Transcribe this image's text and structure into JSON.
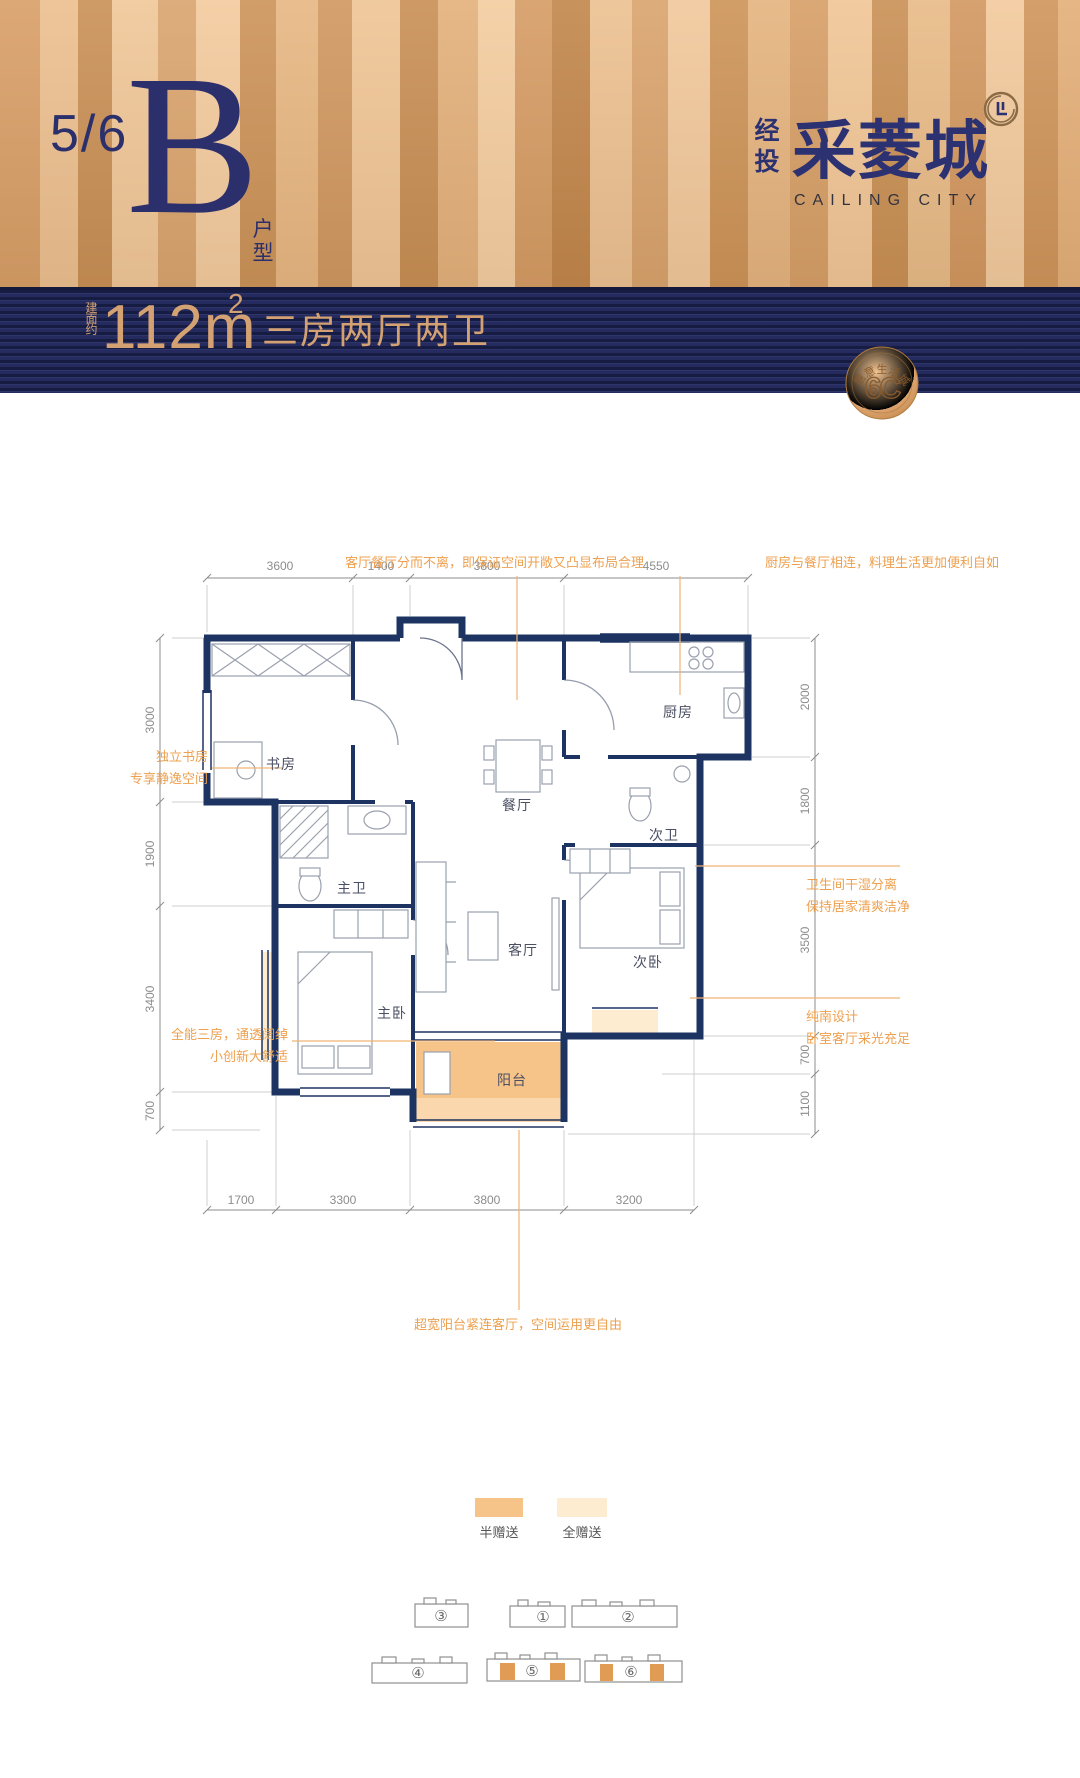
{
  "header": {
    "floors": "5/6",
    "unit": "B",
    "unit_type": "户型",
    "brand_prefix": "经投",
    "brand_name": "采菱城",
    "brand_en": "CAILING CITY"
  },
  "banner": {
    "area_prefix": "建面约",
    "area_value": "112m",
    "area_sup": "2",
    "layout": "三房两厅两卫",
    "badge_ring": "惬意生活城",
    "badge_center": "6C"
  },
  "annotations": {
    "dining": "客厅餐厅分而不离，即保证空间开敞又凸显布局合理",
    "kitchen": "厨房与餐厅相连，料理生活更加便利自如",
    "study1": "独立书房",
    "study2": "专享静逸空间",
    "rooms1": "全能三房，通透阔绰",
    "rooms2": "小创新大舒适",
    "bath1": "卫生间干湿分离",
    "bath2": "保持居家清爽洁净",
    "south1": "纯南设计",
    "south2": "卧室客厅采光充足",
    "balcony": "超宽阳台紧连客厅，空间运用更自由"
  },
  "rooms": {
    "study": "书房",
    "dining": "餐厅",
    "kitchen": "厨房",
    "bath2": "次卫",
    "bath1": "主卫",
    "living": "客厅",
    "bed1": "主卧",
    "bed2": "次卧",
    "balcony": "阳台"
  },
  "dims": {
    "top": [
      "3600",
      "1400",
      "3800",
      "4550"
    ],
    "bottom": [
      "1700",
      "3300",
      "3800",
      "3200"
    ],
    "left": [
      "3000",
      "1900",
      "3400",
      "700"
    ],
    "right": [
      "2000",
      "1800",
      "3500",
      "700",
      "1100"
    ]
  },
  "legend": {
    "half": "半赠送",
    "full": "全赠送"
  },
  "site": {
    "buildings": [
      "③",
      "①",
      "②",
      "④",
      "⑤",
      "⑥"
    ]
  },
  "colors": {
    "navy": "#2b2f6c",
    "banner_navy": "#252b5e",
    "gold_text": "#d4a172",
    "annotation_orange": "#eda04f",
    "half_gift": "#f6c388",
    "full_gift": "#fdeccf",
    "wall_navy": "#1d3462"
  }
}
